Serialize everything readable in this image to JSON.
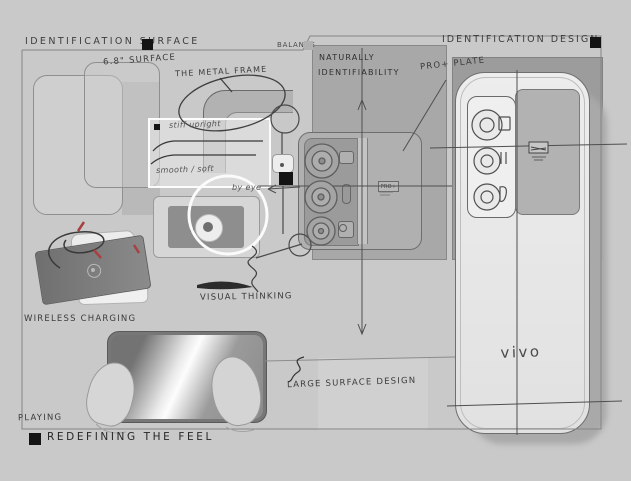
{
  "colors": {
    "background": "#c9c9c9",
    "panel_center": "#a8a8a8",
    "panel_right": "#9c9c9c",
    "ink": "#3b3b3b",
    "accent_red": "#a84040",
    "marker_black": "#141414",
    "callout_white": "#fafafa"
  },
  "header": {
    "left_title": "IDENTIFICATION SURFACE",
    "right_title": "IDENTIFICATION DESIGN",
    "balance_label": "BALANCE"
  },
  "annotations": {
    "surface_size": "6.8\" SURFACE",
    "metal_frame": "THE METAL FRAME",
    "naturally_line1": "NATURALLY",
    "naturally_line2": "IDENTIFIABILITY",
    "pro_plate": "PRO+ PLATE",
    "stiff_upright": "stiff upright",
    "smooth_soft": "smooth / soft",
    "by_eye": "by eye",
    "visual_thinking": "VISUAL THINKING",
    "wireless_charging": "WIRELESS CHARGING",
    "large_surface": "LARGE SURFACE DESIGN",
    "playing": "PLAYING"
  },
  "device": {
    "brand_logo": "vivo",
    "plate_badge": "PRO+"
  },
  "footer": {
    "tagline": "REDEFINING THE FEEL"
  }
}
